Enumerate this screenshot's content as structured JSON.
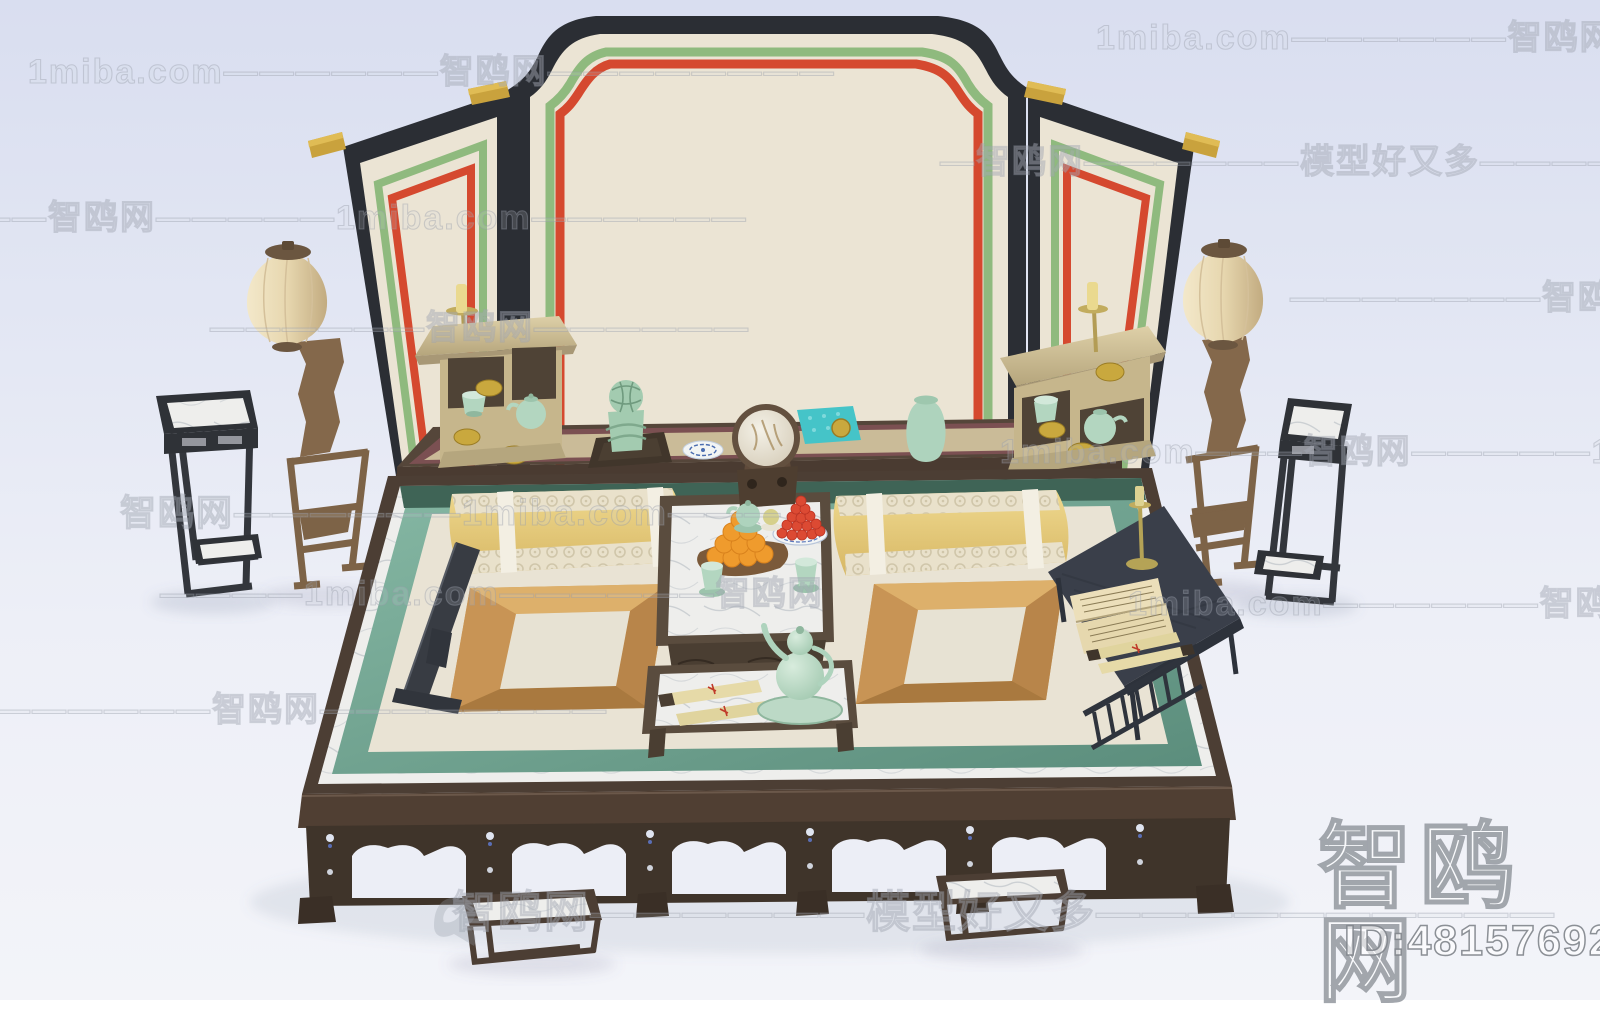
{
  "scene": {
    "description": "3D render of a traditional Chinese luohan daybed set: three-panel screen with green and red pinstripe borders, two lanterns on wooden stands, two tall black incense stands, a long altar table with tea cabinets, celadon censer, round mirror and vase, a large kang bed with yellow bolsters, framed cushions, fruit tea table, gourd ewer, reading table with book and scrolls, and two step stools",
    "objects": [
      "folding-screen",
      "gold-pegs",
      "left-lantern",
      "right-lantern",
      "left-incense-stand",
      "right-incense-stand",
      "altar-table",
      "left-tea-cabinet",
      "right-tea-cabinet",
      "brass-candlesticks",
      "celadon-censer",
      "blue-white-plate",
      "round-mirror",
      "teal-mat",
      "celadon-vase",
      "kang-bed",
      "yellow-bolsters",
      "framed-cushions",
      "armrest",
      "tea-table",
      "orange-tray",
      "berry-plate",
      "tea-cups",
      "scrolls",
      "gourd-ewer",
      "reading-table",
      "open-book",
      "step-stools"
    ]
  },
  "watermarks": {
    "bird_icon": "gull-logo",
    "corner": {
      "brand": "智鸥网",
      "model_id": "ID:481576925"
    },
    "tiled_rows": [
      {
        "x": 28,
        "y": 44,
        "size": 34,
        "text": "1miba.com——————智鸥网————————"
      },
      {
        "x": 1096,
        "y": 10,
        "size": 34,
        "text": "1miba.com——————智鸥网————"
      },
      {
        "x": -60,
        "y": 190,
        "size": 34,
        "text": "———智鸥网—————1miba.com——————"
      },
      {
        "x": 940,
        "y": 134,
        "size": 34,
        "text": "—智鸥网——————模型好又多——————"
      },
      {
        "x": 210,
        "y": 300,
        "size": 34,
        "text": "——————智鸥网——————"
      },
      {
        "x": 1290,
        "y": 270,
        "size": 34,
        "text": "———————智鸥网——"
      },
      {
        "x": 120,
        "y": 484,
        "size": 36,
        "text": "智鸥网——————1miba.com———"
      },
      {
        "x": 1000,
        "y": 424,
        "size": 34,
        "text": "1miba.com———智鸥网—————1miba.com"
      },
      {
        "x": 160,
        "y": 566,
        "size": 34,
        "text": "————1miba.com——————智鸥网"
      },
      {
        "x": 1128,
        "y": 576,
        "size": 34,
        "text": "1miba.com——————智鸥网————"
      },
      {
        "x": -40,
        "y": 682,
        "size": 34,
        "text": "———————智鸥网————————"
      },
      {
        "x": 452,
        "y": 876,
        "size": 44,
        "text": "智鸥网——————模型好又多——————————"
      }
    ]
  },
  "colors": {
    "background_top": "#d9def0",
    "background_bottom": "#f3f4f9",
    "screen_frame_black": "#2b2e34",
    "panel_cream": "#ebe4d4",
    "stripe_green": "#8fba7e",
    "stripe_red": "#d5492f",
    "gold_peg": "#c9a23d",
    "lantern_cream": "#e9dab8",
    "stand_wood_brown": "#7d6347",
    "incense_stand_black": "#33363c",
    "marble_white": "#ebebe9",
    "altar_wood": "#4a3b31",
    "mat_tan": "#cabb98",
    "mat_border_maroon": "#7b5052",
    "cabinet_khaki": "#c6b68c",
    "celadon_green": "#aed3bd",
    "teal_mat": "#45c4c8",
    "bed_border_green": "#74a892",
    "bed_mat_cream": "#e8e2d3",
    "bolster_yellow": "#e3c477",
    "cushion_frame_gold": "#cf9e5b",
    "reading_table_slate": "#3a3f4a",
    "orange_fruit": "#ef9b2d",
    "berry_red": "#dc4a33",
    "brass": "#b5a356"
  }
}
